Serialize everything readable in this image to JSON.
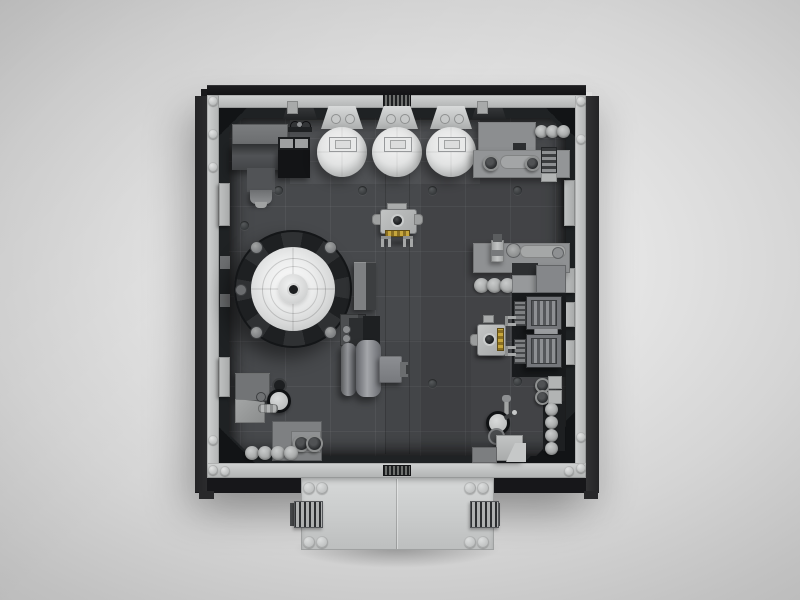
{
  "scene": {
    "description": "Top-down 3D render of a LEGO modular room interior (engine workshop) on a neutral gray studio backdrop",
    "view": "orthographic top view",
    "visible_text": "none"
  },
  "palette": {
    "backdrop_edge": "#b2b2b2",
    "backdrop_center": "#ededed",
    "outer_frame_black": "#141417",
    "inner_rail_gray": "#c3c5c6",
    "wall_shadow": "#1f2224",
    "floor_gray": "#47494c",
    "light_bricks": "#e8e9e9",
    "mid_bricks": "#8e9092",
    "dark_bricks": "#3f4143",
    "droid_gold": "#b8962e"
  },
  "objects": [
    {
      "id": "reactor-dome",
      "label": "Round reactor / turbine dome with concentric white rings on dark bladed ring"
    },
    {
      "id": "spherical-tanks",
      "label": "Three white spherical tanks hung from the top wall with funnels and hatches",
      "count": 3
    },
    {
      "id": "generator-top-left",
      "label": "Dark gray generator block with hose and black control box"
    },
    {
      "id": "workbench-top-right",
      "label": "Workbench with three canisters, roller tool and round pots"
    },
    {
      "id": "workbench-mid-right",
      "label": "Workbench with bottle, dial, long tool and three barrels"
    },
    {
      "id": "engine-units",
      "label": "Two ribbed engine/vent units on a dark pad by the right wall",
      "count": 2
    },
    {
      "id": "droid-center",
      "label": "Small gray droid with gold tread and claw feet, facing down"
    },
    {
      "id": "droid-right",
      "label": "Small gray droid with gold tread and claw feet, facing right"
    },
    {
      "id": "pump-machine-center",
      "label": "Twin vertical cylinder pump with side duct and dark screens"
    },
    {
      "id": "station-bottom-left",
      "label": "Gauge station with valve, twin rollers and row of four barrels"
    },
    {
      "id": "station-bottom-right",
      "label": "Gauge-and-lever station with crate and column of four barrels"
    },
    {
      "id": "entry-platform",
      "label": "Exterior entry platform with corner studs and side vent grilles"
    },
    {
      "id": "wall-grilles",
      "label": "Dark grille tiles centered on top and bottom walls"
    },
    {
      "id": "wall-pilasters",
      "label": "Light gray pilaster trims along left and right walls"
    }
  ]
}
